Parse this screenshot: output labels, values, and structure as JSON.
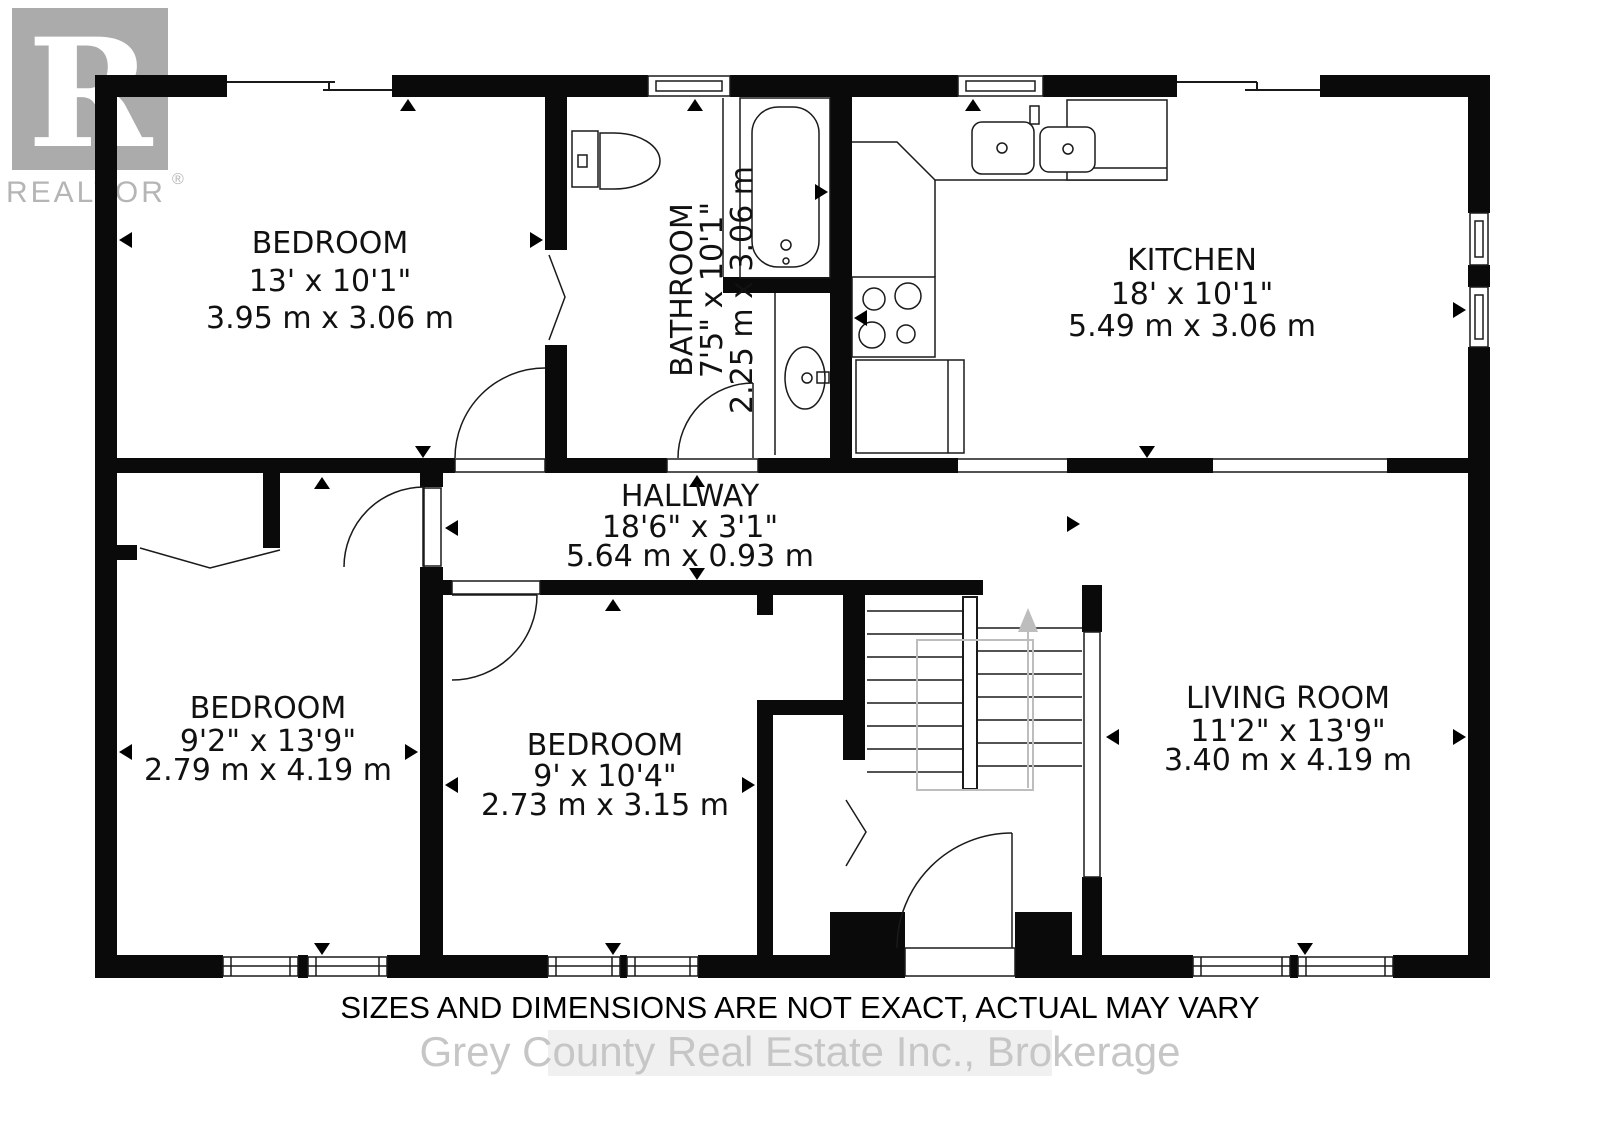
{
  "branding": {
    "logo_letter": "R",
    "logo_text": "REALTOR",
    "registered_symbol": "®"
  },
  "rooms": {
    "bedroom_top_left": {
      "name": "BEDROOM",
      "size_imperial": "13' x 10'1\"",
      "size_metric": "3.95 m x 3.06 m"
    },
    "bathroom": {
      "name": "BATHROOM",
      "size_imperial": "7'5\" x 10'1\"",
      "size_metric": "2.25 m x 3.06 m"
    },
    "kitchen": {
      "name": "KITCHEN",
      "size_imperial": "18' x 10'1\"",
      "size_metric": "5.49 m x 3.06 m"
    },
    "hallway": {
      "name": "HALLWAY",
      "size_imperial": "18'6\" x 3'1\"",
      "size_metric": "5.64 m x 0.93 m"
    },
    "bedroom_bottom_left": {
      "name": "BEDROOM",
      "size_imperial": "9'2\" x 13'9\"",
      "size_metric": "2.79 m x 4.19 m"
    },
    "bedroom_middle": {
      "name": "BEDROOM",
      "size_imperial": "9' x 10'4\"",
      "size_metric": "2.73 m x 3.15 m"
    },
    "living_room": {
      "name": "LIVING ROOM",
      "size_imperial": "11'2\" x 13'9\"",
      "size_metric": "3.40 m x 4.19 m"
    }
  },
  "footer": {
    "disclaimer": "SIZES AND DIMENSIONS ARE NOT EXACT, ACTUAL MAY VARY",
    "watermark": "Grey County Real Estate Inc., Brokerage"
  },
  "colors": {
    "wall": "#0a0a0a",
    "logo_gray": "#ababab",
    "watermark_gray": "#c6c6c6"
  }
}
